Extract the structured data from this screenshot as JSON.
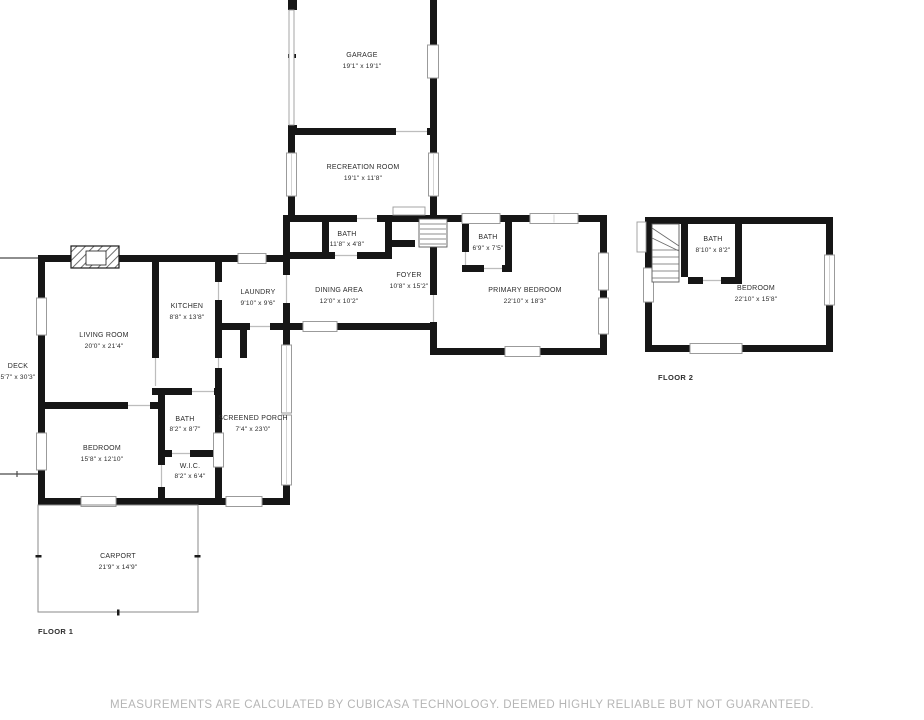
{
  "floor1": {
    "label": "FLOOR 1",
    "rooms": {
      "garage": {
        "name": "GARAGE",
        "dims": "19'1\" x 19'1\""
      },
      "recreation": {
        "name": "RECREATION ROOM",
        "dims": "19'1\" x 11'8\""
      },
      "hall_bath": {
        "name": "BATH",
        "dims": "11'8\" x 4'8\""
      },
      "foyer": {
        "name": "FOYER",
        "dims": "10'8\" x 15'2\""
      },
      "dining": {
        "name": "DINING AREA",
        "dims": "12'0\" x 10'2\""
      },
      "kitchen": {
        "name": "KITCHEN",
        "dims": "8'8\" x 13'8\""
      },
      "laundry": {
        "name": "LAUNDRY",
        "dims": "9'10\" x 9'6\""
      },
      "living": {
        "name": "LIVING ROOM",
        "dims": "20'0\" x 21'4\""
      },
      "deck": {
        "name": "DECK",
        "dims": "5'7\" x 30'3\""
      },
      "primary_bath": {
        "name": "BATH",
        "dims": "6'9\" x 7'5\""
      },
      "primary_bedroom": {
        "name": "PRIMARY BEDROOM",
        "dims": "22'10\" x 18'3\""
      },
      "bedroom": {
        "name": "BEDROOM",
        "dims": "15'8\" x 12'10\""
      },
      "bath": {
        "name": "BATH",
        "dims": "8'2\" x 8'7\""
      },
      "wic": {
        "name": "W.I.C.",
        "dims": "8'2\" x 6'4\""
      },
      "screened_porch": {
        "name": "SCREENED PORCH",
        "dims": "7'4\" x 23'0\""
      },
      "carport": {
        "name": "CARPORT",
        "dims": "21'9\" x 14'9\""
      }
    }
  },
  "floor2": {
    "label": "FLOOR 2",
    "rooms": {
      "bath": {
        "name": "BATH",
        "dims": "8'10\" x 8'2\""
      },
      "bedroom": {
        "name": "BEDROOM",
        "dims": "22'10\" x 15'8\""
      }
    }
  },
  "footer": {
    "disclaimer": "MEASUREMENTS ARE CALCULATED BY CUBICASA TECHNOLOGY. DEEMED HIGHLY RELIABLE BUT NOT GUARANTEED."
  },
  "colors": {
    "wall": "#161616",
    "window_border": "#9b9b9b",
    "label_text": "#2b2b2b",
    "footer_text": "#b5b5b5"
  }
}
